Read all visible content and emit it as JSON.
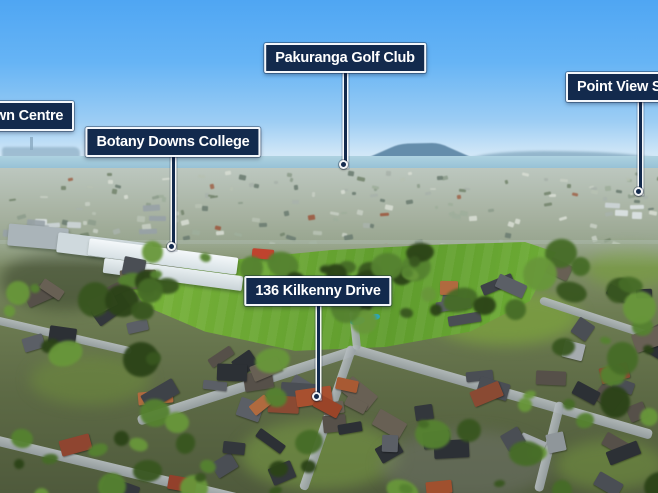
{
  "palette": {
    "label_background": "#132a4d",
    "label_border": "#f4f7fb",
    "label_text": "#ffffff",
    "leader_line": "#132a4d",
    "sky_top": "#4fa6f3",
    "sky_horizon": "#e3f0f9",
    "sea": "#8fbcd3",
    "volcano": "#5d86a5",
    "field_green": "#5f9c2d"
  },
  "annotations": {
    "labels": [
      {
        "id": "botany-town-centre",
        "text": "wn Centre",
        "clipped": "left"
      },
      {
        "id": "botany-downs-college",
        "text": "Botany Downs College",
        "clipped": "none"
      },
      {
        "id": "pakuranga-golf-club",
        "text": "Pakuranga Golf Club",
        "clipped": "none"
      },
      {
        "id": "point-view",
        "text": "Point View S",
        "clipped": "right"
      },
      {
        "id": "136-kilkenny-drive",
        "text": "136 Kilkenny Drive",
        "clipped": "none"
      }
    ]
  }
}
